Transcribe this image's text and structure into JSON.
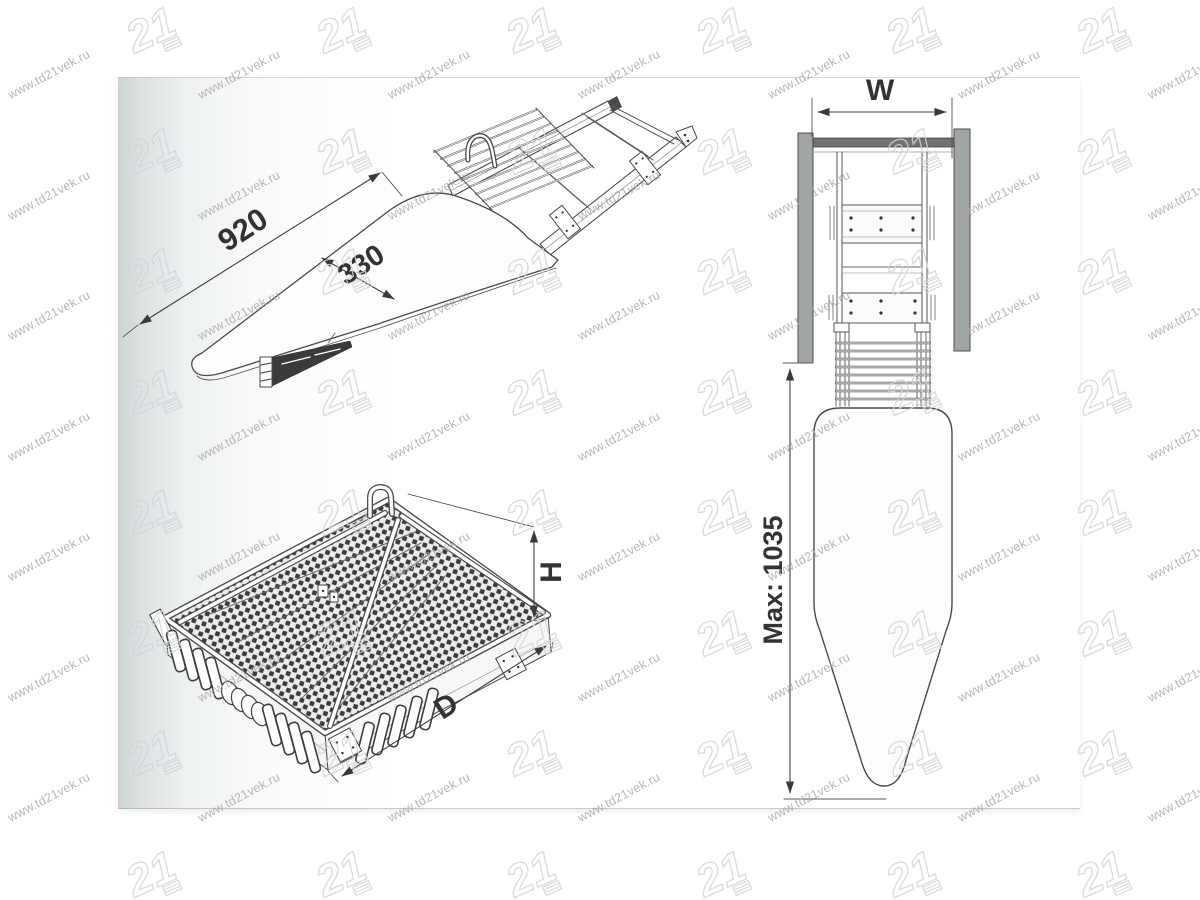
{
  "paper": {
    "background": "#ffffff",
    "edge_shade": "#ced3d3"
  },
  "watermark": {
    "text": "www.td21vek.ru",
    "logo_text": "21",
    "text_color": "#a9a5a0",
    "logo_stroke": "#d2d5d8",
    "rotation_deg": -28,
    "grid": {
      "col_spacing": 190,
      "row_spacing": 120.5,
      "text_origin": {
        "x": 12,
        "y": 88
      },
      "text_cols": 7,
      "text_rows": 7,
      "logo_origin": {
        "x": 122,
        "y": 2
      },
      "logo_cols": 6,
      "logo_rows": 8
    }
  },
  "drawings": {
    "extended_view": {
      "length_label": "920",
      "width_label": "330"
    },
    "folded_view": {
      "height_label": "H",
      "depth_label": "D"
    },
    "front_view": {
      "width_label": "W",
      "max_length_label": "Max: 1035"
    }
  },
  "line_color": "#4a4a4a",
  "label_color": "#333333"
}
